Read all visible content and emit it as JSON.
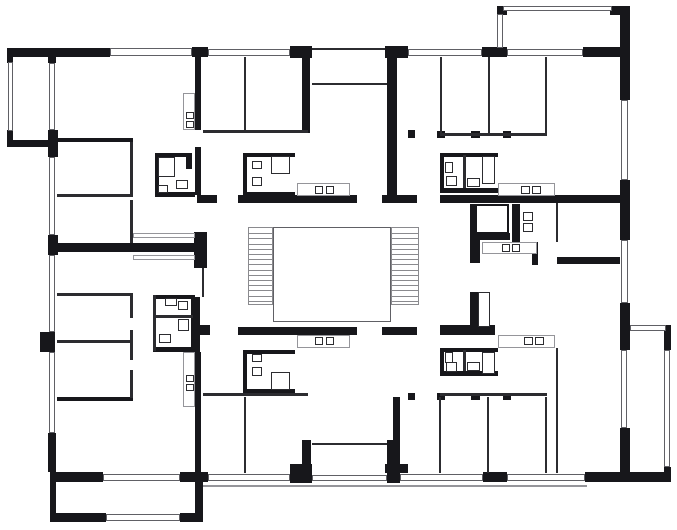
{
  "canvas": {
    "width": 677,
    "height": 530,
    "background": "#ffffff"
  },
  "colors": {
    "wall": "#17171b",
    "partition": "#2c2c30",
    "window_frame": "#606065",
    "counter_outline": "#95959a",
    "tread": "#8a8a8e"
  },
  "elements": [
    [
      "wall",
      7,
      48,
      103,
      9,
      "exterior-wall-top"
    ],
    [
      "wall",
      192,
      47,
      16,
      10,
      "exterior-wall-top"
    ],
    [
      "wall",
      290,
      46,
      22,
      12,
      "entry-pillar-left"
    ],
    [
      "wall",
      385,
      46,
      23,
      12,
      "entry-pillar-right"
    ],
    [
      "wall",
      482,
      47,
      25,
      10,
      "exterior-wall-top"
    ],
    [
      "wall",
      583,
      47,
      47,
      10,
      "exterior-wall-top"
    ],
    [
      "wall",
      497,
      6,
      10,
      9,
      "balcony-corner"
    ],
    [
      "wall",
      610,
      6,
      20,
      9,
      "balcony-corner"
    ],
    [
      "wall",
      620,
      10,
      10,
      90,
      "exterior-wall-right"
    ],
    [
      "wall",
      620,
      180,
      10,
      60,
      "exterior-wall-right"
    ],
    [
      "wall",
      620,
      303,
      10,
      47,
      "exterior-wall-right"
    ],
    [
      "wall",
      620,
      428,
      10,
      44,
      "exterior-wall-right"
    ],
    [
      "wall",
      48,
      48,
      8,
      15,
      "exterior-wall-left"
    ],
    [
      "wall",
      48,
      130,
      10,
      27,
      "exterior-wall-left"
    ],
    [
      "wall",
      48,
      235,
      10,
      20,
      "exterior-wall-left"
    ],
    [
      "wall",
      40,
      332,
      15,
      20,
      "exterior-wall-left"
    ],
    [
      "wall",
      48,
      433,
      8,
      39,
      "exterior-wall-left"
    ],
    [
      "wall",
      7,
      48,
      6,
      15,
      "balcony-corner"
    ],
    [
      "wall",
      7,
      130,
      6,
      17,
      "balcony-corner"
    ],
    [
      "wall",
      7,
      140,
      49,
      7,
      "balcony-edge"
    ],
    [
      "wall",
      50,
      472,
      53,
      10,
      "exterior-wall-bottom"
    ],
    [
      "wall",
      180,
      472,
      28,
      10,
      "exterior-wall-bottom"
    ],
    [
      "wall",
      290,
      472,
      22,
      11,
      "entry-pillar-left"
    ],
    [
      "wall",
      387,
      472,
      13,
      11,
      "entry-pillar-right"
    ],
    [
      "wall",
      483,
      472,
      24,
      10,
      "exterior-wall-bottom"
    ],
    [
      "wall",
      585,
      472,
      45,
      10,
      "exterior-wall-bottom"
    ],
    [
      "wall",
      630,
      472,
      41,
      10,
      "balcony-edge"
    ],
    [
      "wall",
      50,
      482,
      6,
      33,
      "balcony-edge"
    ],
    [
      "wall",
      50,
      513,
      56,
      9,
      "balcony-edge"
    ],
    [
      "wall",
      180,
      513,
      23,
      9,
      "balcony-edge"
    ],
    [
      "wall",
      195,
      482,
      8,
      38,
      "balcony-edge"
    ],
    [
      "wall",
      664,
      325,
      7,
      25,
      "balcony-corner"
    ],
    [
      "wall",
      664,
      467,
      7,
      15,
      "balcony-corner"
    ],
    [
      "wall",
      197,
      195,
      20,
      8,
      "corridor-wall"
    ],
    [
      "wall",
      238,
      195,
      119,
      8,
      "corridor-wall"
    ],
    [
      "wall",
      382,
      195,
      35,
      8,
      "corridor-wall"
    ],
    [
      "wall",
      440,
      195,
      187,
      8,
      "corridor-wall"
    ],
    [
      "wall",
      197,
      325,
      13,
      10,
      "corridor-wall"
    ],
    [
      "wall",
      238,
      327,
      119,
      8,
      "corridor-wall"
    ],
    [
      "wall",
      382,
      327,
      35,
      8,
      "corridor-wall"
    ],
    [
      "wall",
      440,
      325,
      55,
      10,
      "corridor-wall"
    ],
    [
      "wall",
      50,
      243,
      145,
      9,
      "party-wall"
    ],
    [
      "wall",
      194,
      232,
      13,
      36,
      "party-wall-block"
    ],
    [
      "wall",
      195,
      57,
      6,
      73,
      "unit-wall"
    ],
    [
      "wall",
      195,
      147,
      6,
      48,
      "unit-wall"
    ],
    [
      "wall",
      191,
      297,
      9,
      55,
      "unit-wall"
    ],
    [
      "wall",
      195,
      352,
      6,
      121,
      "unit-wall"
    ],
    [
      "wall",
      302,
      50,
      8,
      83,
      "unit-wall"
    ],
    [
      "wall",
      387,
      58,
      10,
      145,
      "unit-wall"
    ],
    [
      "wall",
      302,
      440,
      9,
      32,
      "unit-wall"
    ],
    [
      "wall",
      387,
      440,
      10,
      32,
      "unit-wall"
    ],
    [
      "wall",
      290,
      464,
      22,
      9,
      "entry-pillar-left"
    ],
    [
      "wall",
      385,
      464,
      23,
      9,
      "entry-pillar-right"
    ],
    [
      "wall",
      393,
      397,
      7,
      76,
      "unit-wall"
    ],
    [
      "wall",
      57,
      138,
      76,
      4,
      "room-wall"
    ],
    [
      "wall",
      57,
      397,
      76,
      4,
      "room-wall"
    ],
    [
      "wall",
      155,
      153,
      35,
      4,
      "bathroom-wall"
    ],
    [
      "wall",
      155,
      153,
      4,
      44,
      "bathroom-wall"
    ],
    [
      "wall",
      155,
      192,
      40,
      5,
      "bathroom-wall"
    ],
    [
      "wall",
      186,
      153,
      6,
      16,
      "bathroom-wall"
    ],
    [
      "wall",
      243,
      153,
      52,
      4,
      "bathroom-wall"
    ],
    [
      "wall",
      243,
      153,
      4,
      44,
      "bathroom-wall"
    ],
    [
      "wall",
      243,
      192,
      52,
      5,
      "bathroom-wall"
    ],
    [
      "wall",
      440,
      153,
      58,
      4,
      "bathroom-wall"
    ],
    [
      "wall",
      440,
      188,
      58,
      5,
      "bathroom-wall"
    ],
    [
      "wall",
      440,
      153,
      4,
      39,
      "bathroom-wall"
    ],
    [
      "wall",
      153,
      295,
      42,
      4,
      "bathroom-wall"
    ],
    [
      "wall",
      153,
      347,
      42,
      5,
      "bathroom-wall"
    ],
    [
      "wall",
      243,
      350,
      52,
      4,
      "bathroom-wall"
    ],
    [
      "wall",
      243,
      350,
      4,
      43,
      "bathroom-wall"
    ],
    [
      "wall",
      243,
      389,
      52,
      4,
      "bathroom-wall"
    ],
    [
      "wall",
      440,
      348,
      58,
      4,
      "bathroom-wall"
    ],
    [
      "wall",
      440,
      371,
      58,
      5,
      "bathroom-wall"
    ],
    [
      "wall",
      440,
      348,
      4,
      28,
      "bathroom-wall"
    ],
    [
      "wall",
      470,
      204,
      6,
      36,
      "elevator-wall"
    ],
    [
      "wall",
      470,
      233,
      40,
      7,
      "elevator-wall"
    ],
    [
      "wall",
      470,
      240,
      10,
      23,
      "unit-wall"
    ],
    [
      "wall",
      512,
      204,
      8,
      38,
      "wc-wall"
    ],
    [
      "wall",
      532,
      242,
      6,
      23,
      "unit-wall"
    ],
    [
      "wall",
      557,
      257,
      63,
      7,
      "room-wall"
    ],
    [
      "wall",
      470,
      292,
      8,
      35,
      "duct-wall"
    ],
    [
      "wall",
      408,
      130,
      7,
      8,
      "door-jamb"
    ],
    [
      "wall",
      437,
      131,
      8,
      7,
      "door-jamb"
    ],
    [
      "wall",
      471,
      131,
      9,
      7,
      "door-jamb"
    ],
    [
      "wall",
      503,
      131,
      8,
      7,
      "door-jamb"
    ],
    [
      "wall",
      408,
      393,
      7,
      7,
      "door-jamb"
    ],
    [
      "wall",
      437,
      393,
      8,
      7,
      "door-jamb"
    ],
    [
      "wall",
      471,
      393,
      9,
      7,
      "door-jamb"
    ],
    [
      "wall",
      503,
      393,
      8,
      7,
      "door-jamb"
    ],
    [
      "thin",
      312,
      48,
      73,
      2,
      "entry-recess-face"
    ],
    [
      "thin",
      130,
      142,
      3,
      52,
      "partition-wall"
    ],
    [
      "thin",
      130,
      200,
      3,
      43,
      "partition-wall"
    ],
    [
      "thin",
      57,
      194,
      76,
      3,
      "partition-wall"
    ],
    [
      "thin",
      57,
      293,
      76,
      3,
      "partition-wall"
    ],
    [
      "thin",
      57,
      340,
      76,
      3,
      "partition-wall"
    ],
    [
      "thin",
      130,
      293,
      3,
      25,
      "partition-wall"
    ],
    [
      "thin",
      130,
      330,
      3,
      30,
      "partition-wall"
    ],
    [
      "thin",
      130,
      370,
      3,
      28,
      "partition-wall"
    ],
    [
      "thin",
      244,
      57,
      2,
      76,
      "partition-wall"
    ],
    [
      "thin",
      203,
      130,
      105,
      3,
      "partition-wall"
    ],
    [
      "thin",
      488,
      57,
      2,
      76,
      "partition-wall"
    ],
    [
      "thin",
      545,
      57,
      2,
      76,
      "partition-wall"
    ],
    [
      "thin",
      440,
      57,
      2,
      79,
      "partition-wall"
    ],
    [
      "thin",
      440,
      133,
      107,
      3,
      "partition-wall"
    ],
    [
      "thin",
      244,
      397,
      2,
      76,
      "partition-wall"
    ],
    [
      "thin",
      203,
      393,
      105,
      3,
      "partition-wall"
    ],
    [
      "thin",
      439,
      397,
      2,
      76,
      "partition-wall"
    ],
    [
      "thin",
      487,
      397,
      2,
      76,
      "partition-wall"
    ],
    [
      "thin",
      545,
      397,
      2,
      76,
      "partition-wall"
    ],
    [
      "thin",
      440,
      393,
      107,
      3,
      "partition-wall"
    ],
    [
      "thin",
      556,
      203,
      2,
      39,
      "partition-wall"
    ],
    [
      "thin",
      556,
      348,
      2,
      125,
      "partition-wall"
    ],
    [
      "thin",
      463,
      155,
      3,
      33,
      "bathroom-partition"
    ],
    [
      "thin",
      463,
      350,
      3,
      21,
      "bathroom-partition"
    ],
    [
      "thin",
      155,
      315,
      38,
      3,
      "bathroom-partition"
    ],
    [
      "thin",
      153,
      295,
      3,
      56,
      "bathroom-partition"
    ],
    [
      "thin",
      202,
      268,
      2,
      29,
      "corridor-edge"
    ],
    [
      "thin",
      312,
      83,
      75,
      2,
      "entry-recess-inner"
    ],
    [
      "thin",
      312,
      443,
      75,
      2,
      "entry-recess-inner"
    ],
    [
      "win",
      110,
      48,
      82,
      8,
      "window"
    ],
    [
      "win",
      208,
      49,
      82,
      7,
      "window"
    ],
    [
      "win",
      408,
      49,
      74,
      7,
      "window"
    ],
    [
      "win",
      507,
      49,
      76,
      7,
      "window"
    ],
    [
      "win",
      503,
      6,
      109,
      5,
      "balcony-railing"
    ],
    [
      "win",
      497,
      14,
      6,
      34,
      "balcony-railing"
    ],
    [
      "win",
      8,
      62,
      5,
      69,
      "balcony-railing"
    ],
    [
      "win",
      49,
      63,
      6,
      67,
      "window"
    ],
    [
      "win",
      49,
      157,
      6,
      78,
      "window"
    ],
    [
      "win",
      49,
      255,
      6,
      77,
      "window"
    ],
    [
      "win",
      49,
      352,
      6,
      81,
      "window"
    ],
    [
      "win",
      621,
      100,
      7,
      80,
      "window"
    ],
    [
      "win",
      621,
      240,
      7,
      63,
      "window"
    ],
    [
      "win",
      621,
      350,
      6,
      78,
      "window"
    ],
    [
      "win",
      103,
      474,
      77,
      7,
      "window"
    ],
    [
      "win",
      208,
      474,
      82,
      7,
      "window"
    ],
    [
      "win",
      312,
      475,
      75,
      6,
      "entry-porch"
    ],
    [
      "win",
      400,
      474,
      83,
      7,
      "window"
    ],
    [
      "win",
      507,
      474,
      78,
      7,
      "window"
    ],
    [
      "win",
      106,
      514,
      74,
      7,
      "balcony-railing"
    ],
    [
      "win",
      630,
      325,
      36,
      6,
      "balcony-railing"
    ],
    [
      "win",
      664,
      350,
      6,
      117,
      "balcony-railing"
    ],
    [
      "gray",
      183,
      93,
      12,
      37,
      "kitchen-counter"
    ],
    [
      "gray",
      297,
      183,
      53,
      13,
      "kitchen-counter"
    ],
    [
      "gray",
      498,
      183,
      57,
      13,
      "kitchen-counter"
    ],
    [
      "gray",
      482,
      242,
      55,
      12,
      "kitchen-counter"
    ],
    [
      "gray",
      297,
      335,
      53,
      13,
      "kitchen-counter"
    ],
    [
      "gray",
      498,
      335,
      57,
      13,
      "kitchen-counter"
    ],
    [
      "gray",
      183,
      352,
      12,
      55,
      "kitchen-counter"
    ],
    [
      "gray",
      133,
      233,
      62,
      5,
      "closet"
    ],
    [
      "gray",
      133,
      255,
      62,
      5,
      "closet"
    ],
    [
      "gline",
      203,
      485,
      384,
      2,
      "terrace-edge"
    ],
    [
      "box",
      158,
      157,
      17,
      20,
      "shower-fixture"
    ],
    [
      "box",
      176,
      180,
      12,
      9,
      "sink-fixture"
    ],
    [
      "box",
      158,
      185,
      10,
      8,
      "wc-fixture"
    ],
    [
      "box",
      252,
      161,
      10,
      8,
      "wc-fixture"
    ],
    [
      "box",
      252,
      177,
      10,
      9,
      "sink-fixture"
    ],
    [
      "box",
      271,
      156,
      19,
      18,
      "shower-fixture"
    ],
    [
      "box",
      445,
      162,
      8,
      11,
      "wc-fixture"
    ],
    [
      "box",
      446,
      176,
      11,
      10,
      "sink-fixture"
    ],
    [
      "box",
      482,
      156,
      13,
      28,
      "shower-fixture"
    ],
    [
      "box",
      467,
      178,
      13,
      9,
      "sink-fixture"
    ],
    [
      "box",
      165,
      298,
      12,
      8,
      "sink-fixture"
    ],
    [
      "box",
      178,
      301,
      10,
      9,
      "sink-fixture"
    ],
    [
      "box",
      178,
      319,
      11,
      12,
      "wc-fixture"
    ],
    [
      "box",
      159,
      334,
      12,
      9,
      "wc-fixture"
    ],
    [
      "box",
      252,
      354,
      10,
      8,
      "wc-fixture"
    ],
    [
      "box",
      252,
      367,
      10,
      9,
      "sink-fixture"
    ],
    [
      "box",
      271,
      372,
      19,
      18,
      "shower-fixture"
    ],
    [
      "box",
      445,
      352,
      8,
      11,
      "wc-fixture"
    ],
    [
      "box",
      446,
      362,
      11,
      10,
      "sink-fixture"
    ],
    [
      "box",
      482,
      352,
      13,
      22,
      "shower-fixture"
    ],
    [
      "box",
      467,
      362,
      13,
      9,
      "sink-fixture"
    ],
    [
      "box",
      480,
      208,
      25,
      22,
      "elevator-car"
    ],
    [
      "box",
      523,
      212,
      10,
      9,
      "wc-fixture"
    ],
    [
      "box",
      523,
      223,
      10,
      9,
      "wc-fixture"
    ],
    [
      "box",
      478,
      292,
      12,
      35,
      "duct-shaft"
    ],
    [
      "box",
      186,
      112,
      8,
      7,
      "stove-burner"
    ],
    [
      "box",
      186,
      121,
      8,
      7,
      "stove-burner"
    ],
    [
      "box",
      315,
      186,
      8,
      8,
      "stove-burner"
    ],
    [
      "box",
      326,
      186,
      8,
      8,
      "stove-burner"
    ],
    [
      "box",
      521,
      186,
      9,
      8,
      "stove-burner"
    ],
    [
      "box",
      532,
      186,
      9,
      8,
      "stove-burner"
    ],
    [
      "box",
      502,
      244,
      8,
      8,
      "stove-burner"
    ],
    [
      "box",
      512,
      244,
      8,
      8,
      "stove-burner"
    ],
    [
      "box",
      315,
      337,
      8,
      8,
      "stove-burner"
    ],
    [
      "box",
      326,
      337,
      8,
      8,
      "stove-burner"
    ],
    [
      "box",
      524,
      337,
      9,
      8,
      "stove-burner"
    ],
    [
      "box",
      535,
      337,
      9,
      8,
      "stove-burner"
    ],
    [
      "box",
      186,
      375,
      8,
      7,
      "stove-burner"
    ],
    [
      "box",
      186,
      384,
      8,
      7,
      "stove-burner"
    ],
    [
      "box2",
      475,
      204,
      34,
      30,
      "elevator-shaft"
    ]
  ],
  "stair": {
    "left_flight": [
      248,
      227,
      25,
      78
    ],
    "right_flight": [
      391,
      227,
      28,
      78
    ],
    "treads_per_flight": 15,
    "landing": [
      273,
      227,
      118,
      95
    ]
  }
}
